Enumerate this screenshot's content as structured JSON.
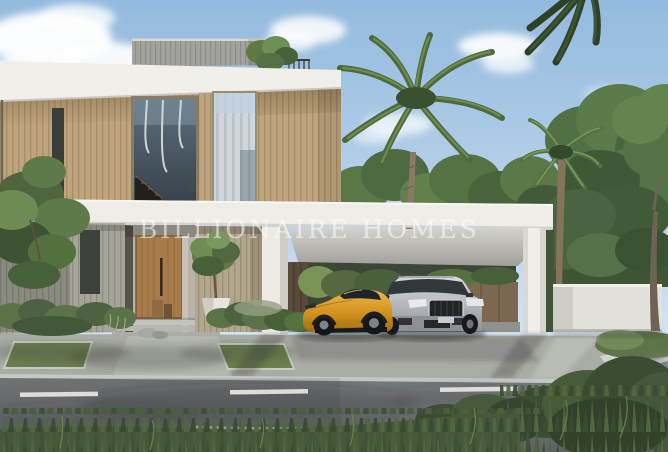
{
  "watermark": {
    "text": "BILLIONAIRE HOMES"
  },
  "scene": {
    "description": "Photoreal exterior rendering of a modern two-storey luxury villa with wood-slat facade, attached white carport sheltering an orange sports car and a silver SUV, palm trees, white boundary wall, entry door with potted tree, sidewalk lawn strips and an asphalt road with dashed lane marking in the foreground under a blue sky with clouds",
    "elements": [
      "sky",
      "clouds",
      "background-trees",
      "palm-trees",
      "villa",
      "roof-terrace",
      "stair-window",
      "curtain-window",
      "front-door",
      "entry-steps",
      "potted-tree",
      "hedges",
      "carport",
      "orange-sports-car",
      "silver-suv",
      "boundary-wall",
      "sidewalk",
      "grass-strips",
      "road",
      "lane-marking",
      "foreground-grass"
    ]
  },
  "colors": {
    "sky_top": "#93bade",
    "sky_horizon": "#e4edf4",
    "cloud_white": "#ffffff",
    "facade_wood": "#bfa57e",
    "facade_white": "#f1efe9",
    "ground_slat_gray": "#a6a599",
    "ground_slat_beige": "#b3a68e",
    "door_wood": "#a87c4a",
    "window_glass": "#4b5a66",
    "curtain_gray": "#cfd7dd",
    "carport_white": "#efede7",
    "boundary_wall": "#e3e1db",
    "sports_car_orange": "#d2921f",
    "suv_silver": "#b6b9bd",
    "palm_green": "#4e6a3c",
    "tree_green": "#547244",
    "hedge_green": "#5a7046",
    "grass_green": "#47573a",
    "sidewalk_gray": "#a9aba5",
    "asphalt_gray": "#74777a",
    "lane_marking_white": "#eceae6"
  }
}
